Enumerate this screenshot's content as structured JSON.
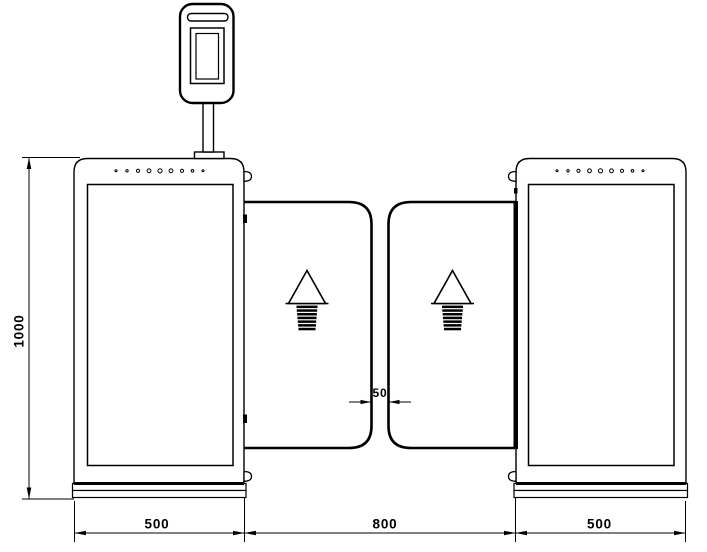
{
  "dimensions": {
    "overall_height": "1000",
    "left_cabinet_width": "500",
    "passage_width": "800",
    "right_cabinet_width": "500",
    "flap_gap": "50"
  },
  "icons": {
    "passage_arrow": "arrow-up-passage-direction",
    "indicator_dots_per_cabinet": 9
  },
  "colors": {
    "line": "#000000",
    "background": "#ffffff"
  }
}
